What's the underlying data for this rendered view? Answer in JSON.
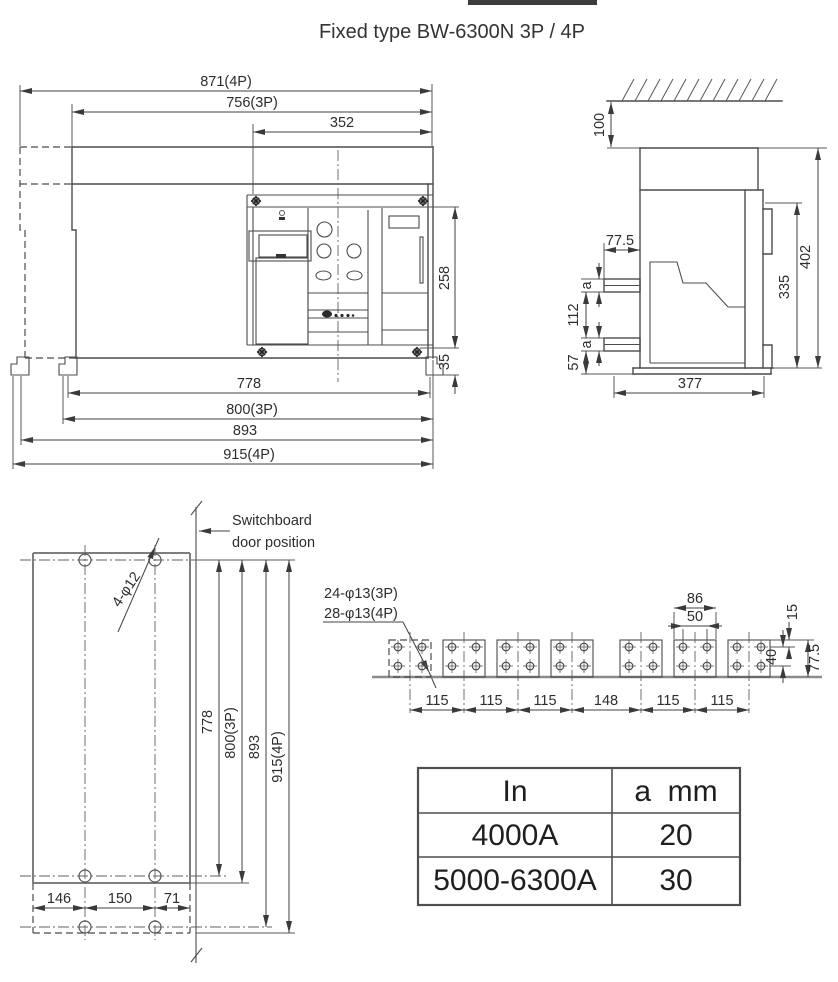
{
  "title": "Fixed type BW-6300N 3P / 4P",
  "front_view": {
    "dim_width_4p": "871(4P)",
    "dim_width_3p": "756(3P)",
    "dim_panel_width": "352",
    "dim_panel_height": "258",
    "dim_foot_height": "35",
    "dim_hole_span": "778",
    "dim_body_3p": "800(3P)",
    "dim_hole_span_4p": "893",
    "dim_body_4p": "915(4P)"
  },
  "side_view": {
    "dim_top_clearance": "100",
    "dim_terminal_length": "77.5",
    "dim_busbar_thickness_upper": "a",
    "dim_terminal_pitch": "112",
    "dim_busbar_thickness_lower": "a",
    "dim_bottom_offset": "57",
    "dim_height_inner": "335",
    "dim_height_overall": "402",
    "dim_depth": "377"
  },
  "mounting_view": {
    "label_door_line1": "Switchboard",
    "label_door_line2": "door position",
    "label_holes": "4-φ12",
    "dim_hole_span": "778",
    "dim_body_3p": "800(3P)",
    "dim_hole_span_4p": "893",
    "dim_body_4p": "915(4P)",
    "dim_left": "146",
    "dim_center": "150",
    "dim_right": "71"
  },
  "busbar_view": {
    "label_holes_3p": "24-φ13(3P)",
    "label_holes_4p": "28-φ13(4P)",
    "dim_tab_width": "86",
    "dim_hole_pitch_h": "50",
    "dim_top_to_hole": "15",
    "dim_hole_pitch_v": "40",
    "dim_tab_height": "77.5",
    "pitches": [
      "115",
      "115",
      "115",
      "148",
      "115",
      "115"
    ]
  },
  "spec_table": {
    "headers": [
      "In",
      "a  mm"
    ],
    "rows": [
      [
        "4000A",
        "20"
      ],
      [
        "5000-6300A",
        "30"
      ]
    ]
  }
}
